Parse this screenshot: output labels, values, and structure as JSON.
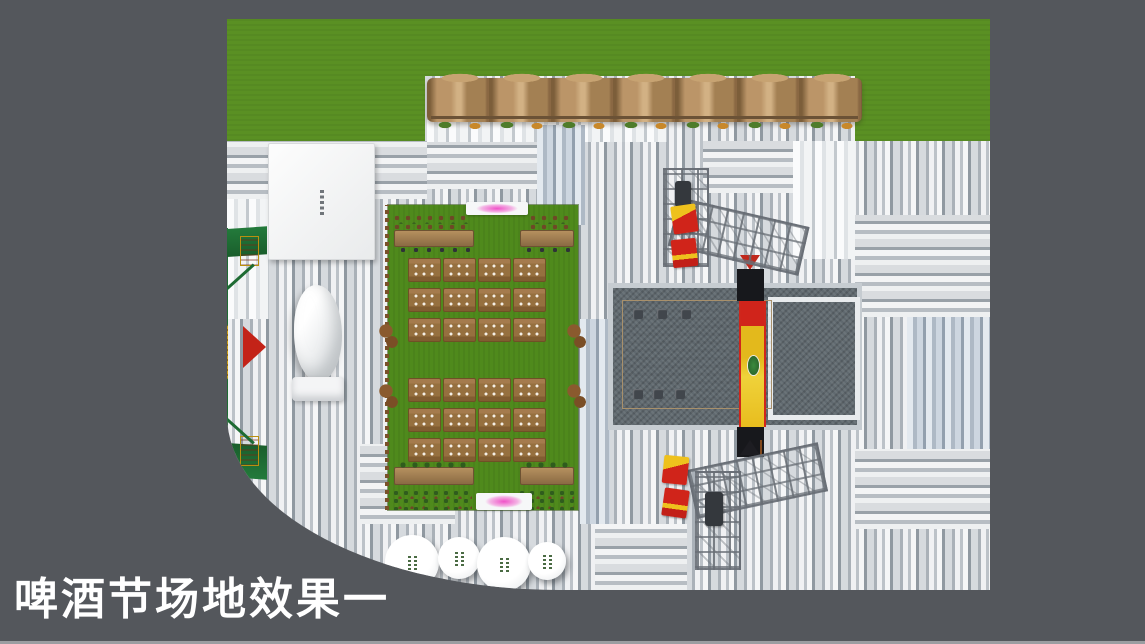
{
  "slide": {
    "title": "啤酒节场地效果一"
  },
  "scene": {
    "name": "beer-festival-venue-top-view-render"
  },
  "lawn": {
    "table_rows": 6,
    "table_cols": 4,
    "seats_per_table": 6,
    "long_counters": 4
  },
  "round_tables": {
    "count": 4
  },
  "colors": {
    "slide_background": "#54575c",
    "title_text": "#ffffff",
    "grass_green": "#5a9023",
    "lawn_green": "#4f8a1c",
    "canopy_brown": "#b08a58",
    "stage_floor_tan": "#c6ad85",
    "carpet_gray": "#60696f",
    "arch_green": "#1e6b33",
    "banner_yellow": "#e8bd1e",
    "banner_red": "#d0241b",
    "accent_pink": "#ef52c8",
    "pavement_light": "#f0f1f3",
    "pavement_dark": "#9099a1"
  }
}
